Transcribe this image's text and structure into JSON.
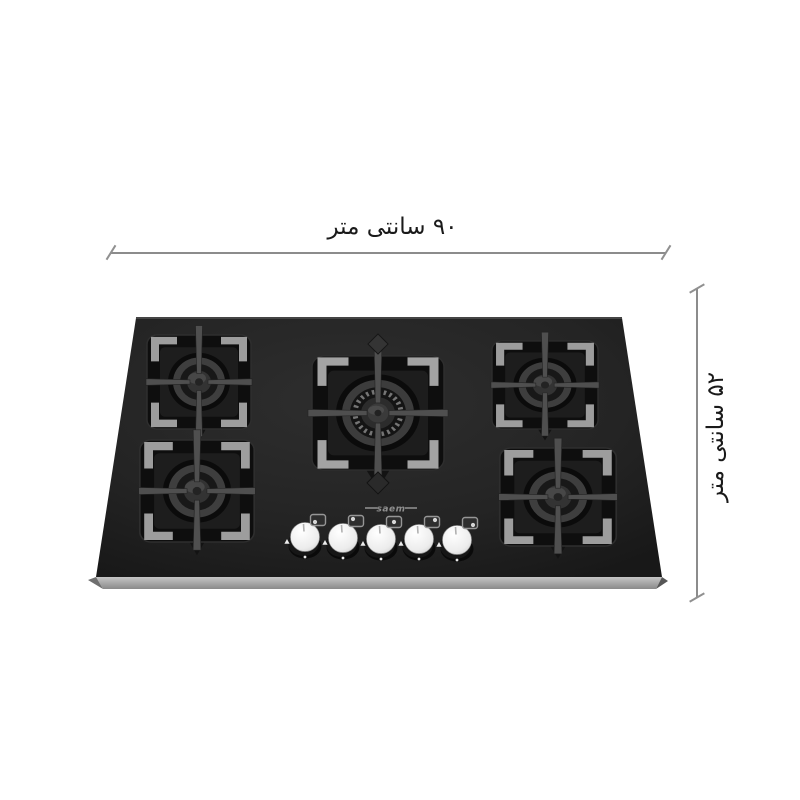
{
  "dimensions": {
    "width_label": "۹۰ سانتی متر",
    "height_label": "۵۲ سانتی متر"
  },
  "brand": {
    "logo_text": "saem"
  },
  "product": {
    "burners": [
      "top-left",
      "top-center",
      "top-right",
      "bottom-left",
      "bottom-right"
    ],
    "knob_count": "5"
  },
  "icons": {
    "dimension_tick": "oblique-tick",
    "knob_flame": "flame",
    "knob_indicator": "burner-position-indicator"
  },
  "colors": {
    "background": "#ffffff",
    "glass_top": "#2c2c2c",
    "glass_bottom": "#191919",
    "bottom_bevel": "#b5b5b5",
    "trivet_frame": "#0e0e0e",
    "trivet_accent": "#9d9d9d",
    "knob_face": "#f5f5f5",
    "dimension_line": "#8c8c8c",
    "label_text": "#1a1a1a"
  }
}
